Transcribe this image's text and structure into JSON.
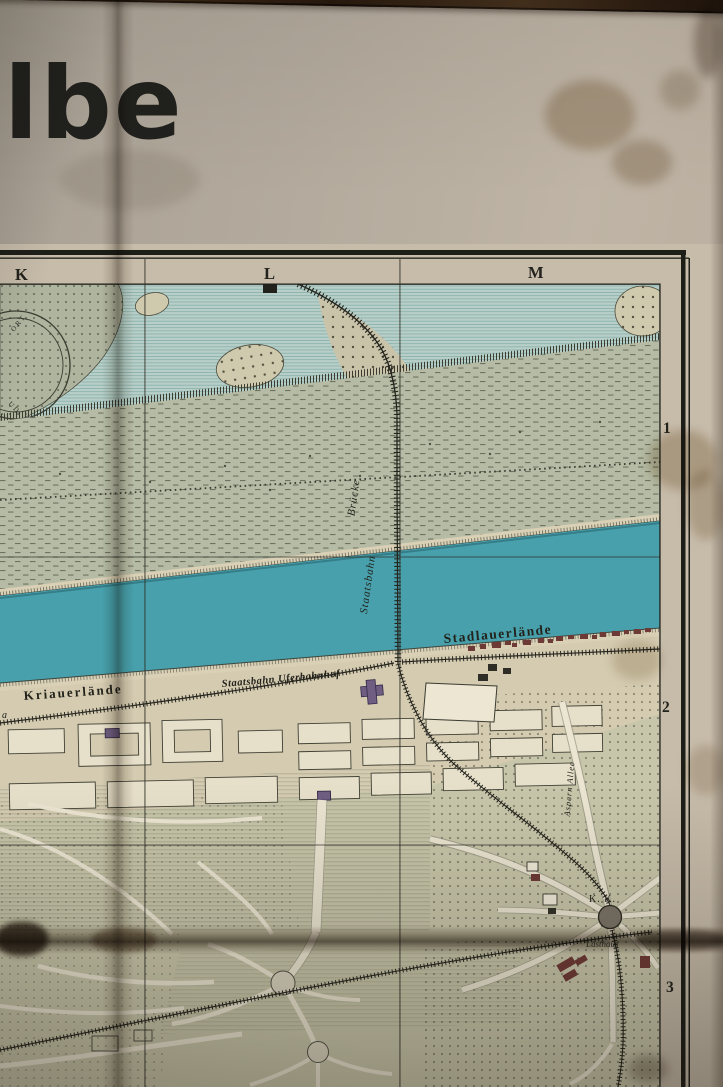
{
  "photo": {
    "description": "aged folded paper city map lying on a dark wood table",
    "title_fragment": "lbe"
  },
  "grid": {
    "columns": [
      "K",
      "L",
      "M"
    ],
    "rows": [
      "1",
      "2",
      "3"
    ]
  },
  "labels": {
    "bank_left": "Kriauerlände",
    "bank_right": "Stadlauerlände",
    "station": "Staatsbahn Uferbahnhof",
    "bridge_word1": "Staatsbahn",
    "bridge_word2": "Brücke",
    "kk": "K. K.",
    "lusthaus": "Lusthaus",
    "allee": "Aspern Allee",
    "edge_fragment": "a",
    "circle_fragment_top": "ORT",
    "circle_fragment_bottom": "UD"
  },
  "colors": {
    "river": "#47a0ac",
    "backwater": "#b7cfc8",
    "floodplain": "#b5bba4",
    "land": "#d4cbb1",
    "park": "#c4c4a8",
    "paper": "#b9b0a2",
    "wood": "#2e1f14",
    "building_red": "#6e3a36",
    "building_purple": "#6f5d82",
    "ink": "#26261f"
  }
}
